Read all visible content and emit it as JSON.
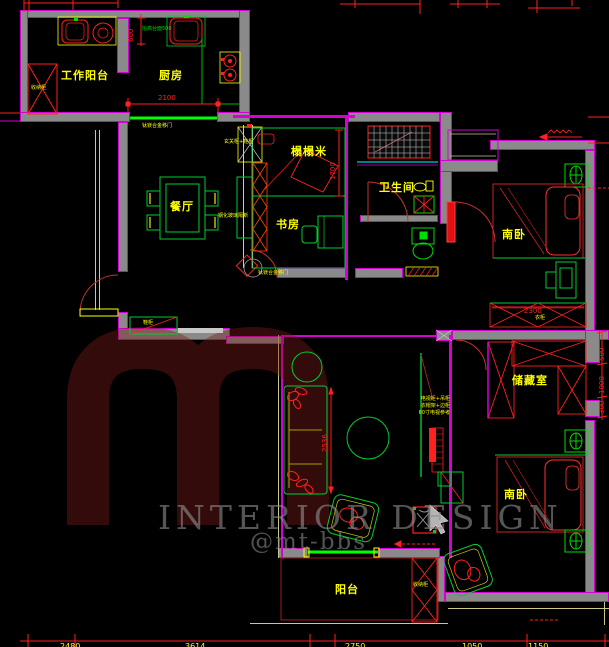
{
  "title": "apartment-floorplan-cad",
  "rooms": {
    "work_balcony": "工作阳台",
    "kitchen": "厨房",
    "dining": "餐厅",
    "tatami": "榻榻米",
    "study": "书房",
    "bathroom": "卫生间",
    "bedroom_south_1": "南卧",
    "storage": "储藏室",
    "bedroom_south_2": "南卧",
    "balcony": "阳台"
  },
  "annotations": {
    "cabinet_left": "收纳柜",
    "cabinet_balcony": "收纳柜",
    "shoe_cabinet": "鞋柜",
    "wardrobe": "衣柜",
    "entry_cabinet": "玄关柜+鞋柜",
    "glass_partition": "钢化玻璃隔断",
    "sliding_door_kitchen": "钛镁合金移门",
    "sliding_door_study": "钛镁合金移门",
    "kitchen_counter_note": "抬高台面500",
    "tv_note_line1": "电视柜+吊柜",
    "tv_note_line2": "衣帽架+边柜",
    "tv_note_line3": "60寸电视参考"
  },
  "dimensions": {
    "balcony_width": "600",
    "kitchen_door": "2100",
    "tatami_length": "1700",
    "wardrobe_width": "2300",
    "sofa_wall": "2536",
    "right_chain": [
      "500",
      "1000",
      "300"
    ],
    "bottom_chain": [
      "2480",
      "3614",
      "2750",
      "1050",
      "1150"
    ]
  },
  "watermark": {
    "brand": "INTERIOR DESIGN",
    "handle": "@mt-bbs"
  },
  "colors": {
    "wall_fill": "#8a8a8a",
    "wall_edge": "#d400d4",
    "dimension_red": "#ff2020",
    "label_yellow": "#ffff00",
    "furniture_green": "#00cc33",
    "sliding_door_green": "#00ff00",
    "bathroom_cyan": "#00ffff"
  }
}
